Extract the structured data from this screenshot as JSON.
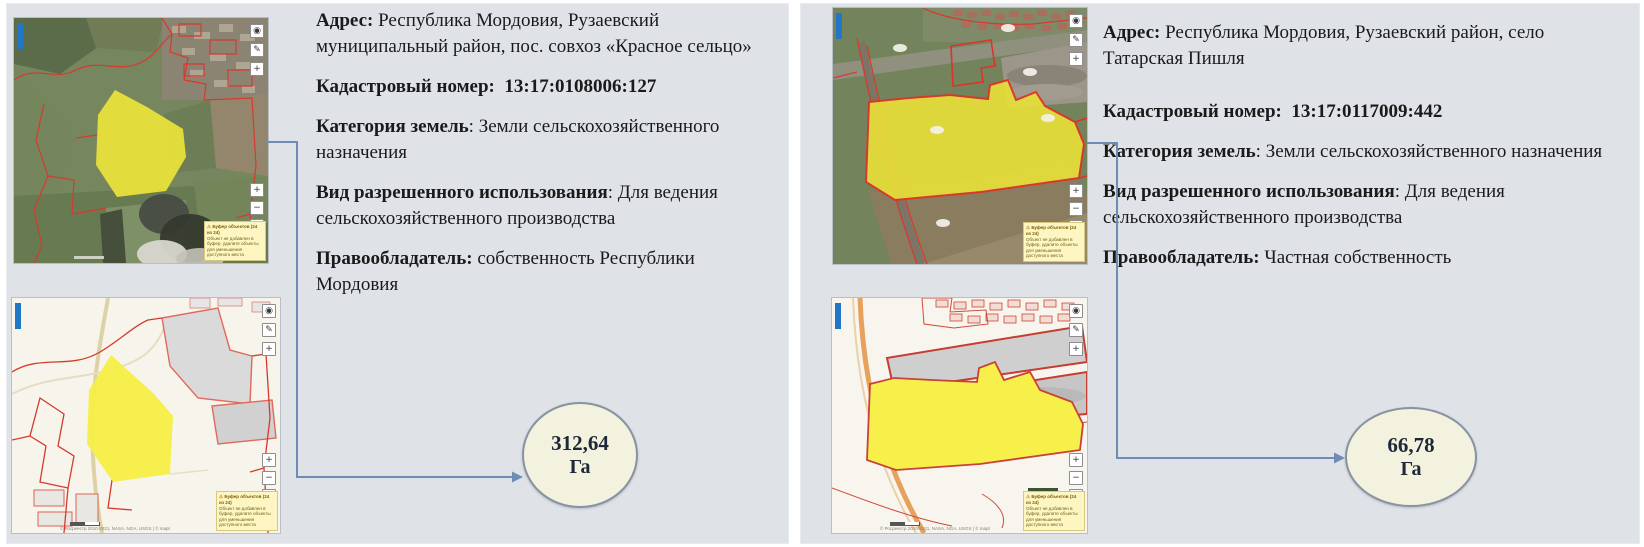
{
  "panels": [
    {
      "name": "Участок 1 — Красное сельцо",
      "fields": [
        {
          "label": "Адрес:",
          "sep": " ",
          "value": "Республика Мордовия, Рузаевский муниципальный район, пос. совхоз «Красное сельцо»"
        },
        {
          "label": "Кадастровый номер:",
          "sep": "  ",
          "value": "13:17:0108006:127"
        },
        {
          "label": "Категория земель",
          "sep": ": ",
          "value": "Земли сельскохозяйственного назначения"
        },
        {
          "label": "Вид разрешенного использования",
          "sep": ": ",
          "value": "Для ведения сельскохозяйственного производства"
        },
        {
          "label": "Правообладатель:",
          "sep": " ",
          "value": "собственность Республики Мордовия"
        }
      ],
      "area": {
        "value": "312,64",
        "unit": "Га"
      }
    },
    {
      "name": "Участок 2 — Татарская Пишля",
      "fields": [
        {
          "label": "Адрес:",
          "sep": " ",
          "value": "Республика Мордовия, Рузаевский район, село Татарская Пишля"
        },
        {
          "label": "Кадастровый номер:",
          "sep": "  ",
          "value": "13:17:0117009:442"
        },
        {
          "label": "Категория земель",
          "sep": ": ",
          "value": "Земли сельскохозяйственного назначения"
        },
        {
          "label": "Вид разрешенного использования",
          "sep": ": ",
          "value": "Для ведения сельскохозяйственного производства"
        },
        {
          "label": "Правообладатель:",
          "sep": " ",
          "value": "Частная собственность"
        }
      ],
      "area": {
        "value": "66,78",
        "unit": "Га"
      }
    }
  ],
  "map_ui": {
    "tool_icons": [
      {
        "name": "layers",
        "glyph": "◉"
      },
      {
        "name": "draw",
        "glyph": "✎"
      },
      {
        "name": "locate",
        "glyph": "+"
      }
    ],
    "zoom_in": "+",
    "zoom_out": "−",
    "tooltip": {
      "icon": "⚠",
      "title": "Буфер объектов (24 из 24)",
      "body": "Объект не добавлен в буфер, удалите объекты для уменьшения доступного места"
    },
    "attribution": "© Росреестр 2010-2021, NASA, NGA, USGS | © mapt"
  },
  "colors": {
    "panel_bg": "#dfe2e7",
    "parcel_yellow": "#ece43a",
    "boundary_red": "#d63a2e",
    "connector_blue": "#6e8cb4",
    "ellipse_fill": "#f2f2de",
    "ellipse_border": "#8793a1"
  }
}
